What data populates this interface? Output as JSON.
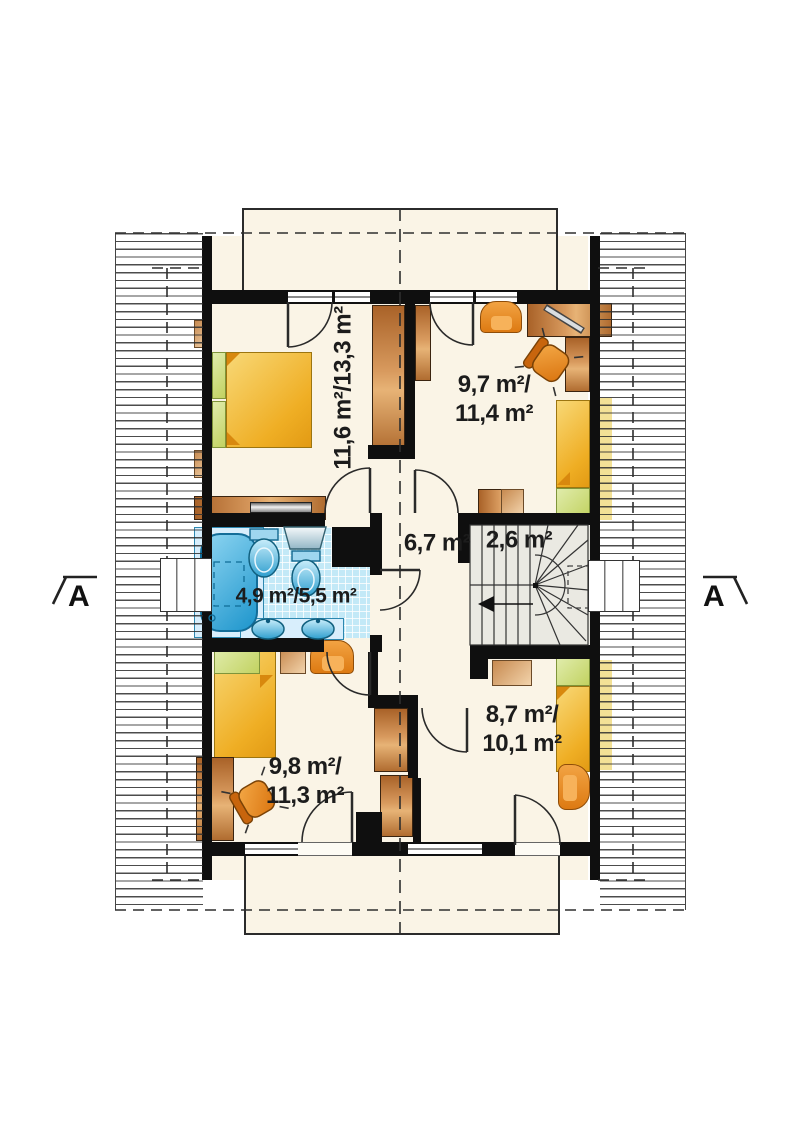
{
  "plan": {
    "title": "attic-floor-plan",
    "section_markers": {
      "left": "A",
      "right": "A"
    },
    "rooms": {
      "bedroom_top_left": {
        "area_label": "11,6 m²/13,3 m²"
      },
      "bedroom_top_right": {
        "area_line1": "9,7 m²/",
        "area_line2": "11,4 m²"
      },
      "hall": {
        "area_label": "6,7 m²"
      },
      "staircase": {
        "area_label": "2,6 m²"
      },
      "bathroom": {
        "area_label": "4,9 m²/5,5 m²"
      },
      "bedroom_bottom_left": {
        "area_line1": "9,8 m²/",
        "area_line2": "11,3 m²"
      },
      "bedroom_bottom_right": {
        "area_line1": "8,7 m²/",
        "area_line2": "10,1 m²"
      }
    },
    "colors": {
      "wall": "#0f0f0f",
      "floor": "#faf4e6",
      "tile_blue": "#c3e9f7",
      "fixture_blue": "#35a9da",
      "wood": "#c9853f",
      "bed_yellow": "#efae24",
      "bed_green": "#c9d874",
      "chair_orange": "#e8871f",
      "stair_gray": "#eae9e2"
    }
  }
}
